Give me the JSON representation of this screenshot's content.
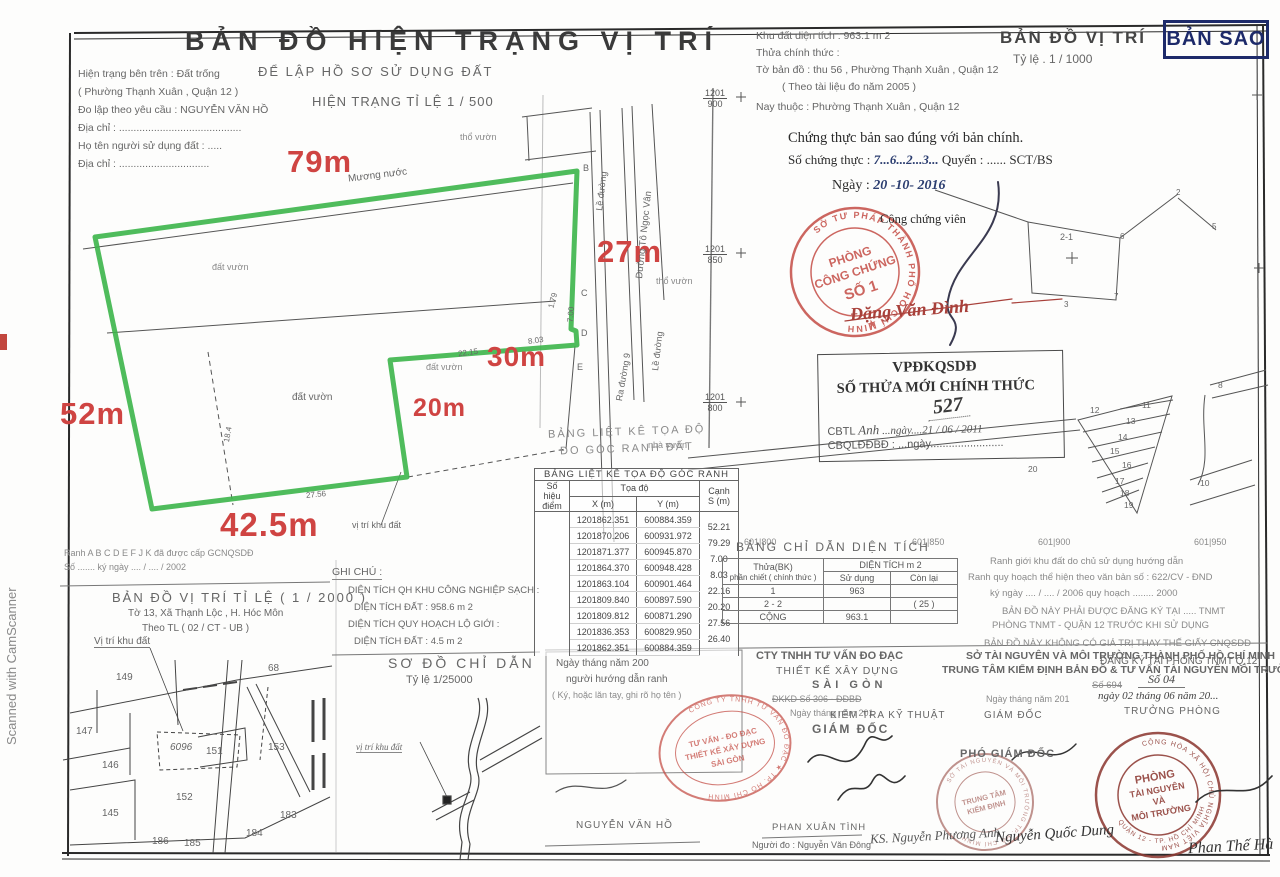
{
  "scan": {
    "watermark": "Scanned with CamScanner",
    "copy_label": "BẢN SAO"
  },
  "header_left": {
    "title": "BẢN ĐỒ HIỆN TRẠNG VỊ TRÍ",
    "subtitle": "ĐỂ LẬP HỒ SƠ SỬ DỤNG ĐẤT",
    "scale_line": "HIỆN TRẠNG TỈ LỆ 1 / 500",
    "lines": [
      "Hiện trạng bên trên : Đất trống",
      "( Phường Thạnh Xuân , Quận 12 )",
      "Đo lập theo yêu cầu : NGUYỄN VĂN HỒ",
      "Địa chỉ : ..........................................",
      "Họ tên người sử dụng đất : .....",
      "Địa chỉ : ..............................."
    ]
  },
  "header_right": {
    "lines": [
      "Khu đất diện tích :   963.1 m 2",
      "Thửa chính thức :",
      "Tờ bản đồ :   thu  56 , Phường Thạnh Xuân , Quận 12",
      "( Theo tài liệu đo năm 2005 )",
      "Nay thuộc :   Phường Thạnh Xuân , Quận 12"
    ],
    "map_title": "BẢN ĐỒ VỊ TRÍ",
    "map_scale": "Tỷ lệ  .  1 /  1000"
  },
  "certification": {
    "line1": "Chứng thực bản sao đúng với bản chính.",
    "line2_prefix": "Số chứng thực :",
    "line2_number": "7...6...2...3...",
    "line2_suffix": "Quyển : ......  SCT/BS",
    "date_label": "Ngày :",
    "date_value": "20 -10- 2016",
    "officer_label": "Công chứng viên",
    "officer_name": "Đặng Văn Đình"
  },
  "stamps": {
    "notary": {
      "ring": "SỞ TƯ PHÁP THÀNH PHỐ HỒ CHÍ MINH",
      "star": "★",
      "center": [
        "PHÒNG",
        "CÔNG CHỨNG",
        "SỐ 1"
      ]
    },
    "company": {
      "ring": "CÔNG TY TNHH TƯ VẤN ĐO ĐẠC ★ TP. HỒ CHÍ MINH",
      "center": [
        "TƯ VẤN - ĐO ĐẠC",
        "THIẾT KẾ XÂY DỰNG",
        "SÀI GÒN"
      ]
    },
    "tnmt": {
      "ring_top": "CỘNG HÒA XÃ HỘI CHỦ NGHĨA VIỆT NAM",
      "ring_bottom": "QUẬN 12 - TP. HỒ CHÍ MINH",
      "center": [
        "PHÒNG",
        "TÀI NGUYÊN",
        "VÀ",
        "MÔI TRƯỜNG"
      ]
    },
    "center_check": {
      "ring": "SỞ TÀI NGUYÊN VÀ MÔI TRƯỜNG TP. HỒ CHÍ MINH",
      "center": [
        "TRUNG TÂM",
        "KIỂM ĐỊNH"
      ]
    }
  },
  "vpdk": {
    "title": "VPĐKQSDĐ",
    "subtitle": "SỐ THỬA MỚI CHÍNH THỨC",
    "number": "527",
    "line1_label": "CBTL",
    "line1_hand": "Anh",
    "line1_date": "...ngày....21 / 06 / 2011",
    "line2_label": "CBQLĐĐBĐ :",
    "line2_date": "...ngày........................"
  },
  "survey": {
    "dims": {
      "top": "79m",
      "right": "27m",
      "mid": "30m",
      "inner": "20m",
      "left": "52m",
      "bottom": "42.5m"
    },
    "edge_numbers": [
      "1.79",
      "7.00",
      "8.03",
      "22.15",
      "27.56",
      "18.4"
    ],
    "points": [
      "B",
      "C",
      "D",
      "E"
    ],
    "labels": {
      "canal": "Mương nước",
      "garden1": "đất vườn",
      "garden2": "đất vườn",
      "garden3": "đất vườn",
      "tho1": "thổ vườn",
      "tho2": "thổ vườn",
      "nha": "nhà vườn",
      "road_side1": "Lề đường",
      "road_main": "Đường Tô Ngọc Vân",
      "road_side2": "Lề đường",
      "road_out": "Ra đường 9",
      "site": "vị trí khu đất"
    },
    "grid_fracs": [
      {
        "t": "1201",
        "b": "900"
      },
      {
        "t": "1201",
        "b": "850"
      },
      {
        "t": "1201",
        "b": "800"
      }
    ],
    "grid_labels": [
      "601|800",
      "601|850",
      "601|900",
      "601|950"
    ]
  },
  "coord_table": {
    "ghost1": "BẢNG LIỆT KÊ TỌA ĐỘ",
    "ghost2": "ĐO GÓC RANH ĐẤT",
    "title": "BẢNG LIỆT KÊ TỌA ĐỘ GÓC RANH",
    "col_point1": "Số hiệu",
    "col_point2": "điểm",
    "col_coord": "Tọa độ",
    "col_x": "X (m)",
    "col_y": "Y (m)",
    "col_edge1": "Cạnh",
    "col_edge2": "S (m)",
    "rows": [
      {
        "p": "",
        "x": "1201862.351",
        "y": "600884.359",
        "s": "52.21"
      },
      {
        "p": "",
        "x": "1201870.206",
        "y": "600931.972",
        "s": "79.29"
      },
      {
        "p": "",
        "x": "1201871.377",
        "y": "600945.870",
        "s": "7.00"
      },
      {
        "p": "",
        "x": "1201864.370",
        "y": "600948.428",
        "s": "8.03"
      },
      {
        "p": "",
        "x": "1201863.104",
        "y": "600901.464",
        "s": "22.16"
      },
      {
        "p": "",
        "x": "1201809.840",
        "y": "600897.590",
        "s": "20.20"
      },
      {
        "p": "",
        "x": "1201809.812",
        "y": "600871.290",
        "s": "27.56"
      },
      {
        "p": "",
        "x": "1201836.353",
        "y": "600829.950",
        "s": "26.40"
      },
      {
        "p": "",
        "x": "1201862.351",
        "y": "600884.359",
        "s": ""
      }
    ]
  },
  "area_table": {
    "title": "BẢNG CHỈ DẪN DIỆN TÍCH",
    "col1a": "Thửa(BK)",
    "col1b": "phần chiết ( chính thức )",
    "col2": "DIỆN TÍCH m 2",
    "col2a": "Sử dụng",
    "col2b": "Còn lại",
    "rows": [
      {
        "c1": "1",
        "c2": "963",
        "c3": ""
      },
      {
        "c1": "2 - 2",
        "c2": "",
        "c3": "( 25 )"
      },
      {
        "c1": "CỘNG",
        "c2": "963.1",
        "c3": ""
      }
    ]
  },
  "notes_right": {
    "lines": [
      "Ranh giới khu đất do chủ sử dụng hướng dẫn",
      "Ranh quy hoạch thể hiện theo văn bản số : 622/CV - ĐND",
      "ký ngày .... / .... / 2006   quy hoạch ........ 2000",
      "BẢN ĐỒ NÀY PHẢI ĐƯỢC ĐĂNG KÝ TẠI ..... TNMT",
      "PHÒNG TNMT - QUẬN 12 TRƯỚC KHI SỬ DỤNG",
      "BẢN ĐỒ NÀY KHÔNG CÓ GIÁ TRỊ THAY THẾ GIẤY CNQSDĐ"
    ]
  },
  "ghi_chu": {
    "title": "GHI CHÚ :",
    "lines": [
      "DIỆN TÍCH QH KHU CÔNG NGHIỆP SẠCH :",
      "DIỆN TÍCH ĐẤT :   958.6 m 2",
      "DIỆN TÍCH QUY HOẠCH LỘ GIỚI :",
      "DIỆN TÍCH ĐẤT :   4.5 m 2"
    ]
  },
  "map2000": {
    "pre1": "Ranh A B C D E F J K đã được cấp GCNQSDĐ",
    "pre2": "Số ....... ký ngày .... / .... / 2002",
    "title": "BẢN ĐỒ VỊ TRÍ TỈ LỆ ( 1 / 2000 )",
    "line2": "Tờ 13,  Xã Thạnh Lộc  ,  H. Hóc Môn",
    "line3": "Theo TL ( 02 / CT - UB )",
    "site_label": "Vị trí khu đất",
    "parcels": [
      "149",
      "68",
      "147",
      "146",
      "145",
      "6096",
      "151",
      "153",
      "152",
      "186",
      "185",
      "184",
      "183"
    ]
  },
  "map1000": {
    "plot": "2-1",
    "corners": [
      "2",
      "5",
      "6",
      "7",
      "3"
    ],
    "strips": [
      "11",
      "12",
      "13",
      "14",
      "15",
      "16",
      "17",
      "18",
      "19"
    ],
    "others": [
      "20",
      "8",
      "10"
    ]
  },
  "so_do": {
    "title": "SƠ ĐỒ CHỈ DẪN",
    "scale": "Tỷ lệ 1/25000",
    "site_label": "vị trí khu đất"
  },
  "sig": {
    "col1": {
      "date_line": "Ngày          tháng          năm 200",
      "role": "người hướng dẫn ranh",
      "note": "( Ký, hoặc lăn tay, ghi rõ họ tên )",
      "name": "NGUYỄN VĂN HỒ"
    },
    "col2": {
      "org1": "CTY TNHH TƯ VẤN ĐO ĐẠC",
      "org2": "THIẾT KẾ XÂY DỰNG",
      "org3": "SÀI GÒN",
      "reg": "ĐKKD  Số  306 - ĐĐBĐ",
      "date_line": "Ngày       tháng       năm 201",
      "role": "GIÁM ĐỐC",
      "name1": "PHAN XUÂN TÌNH",
      "name2": "Người đo :  Nguyễn Văn Đông",
      "name3": "KS. Nguyễn Phương Anh"
    },
    "col3": {
      "org1": "SỞ TÀI NGUYÊN  VÀ  MÔI TRƯỜNG THÀNH PHỐ HỒ CHÍ MINH",
      "org2": "TRUNG TÂM KIỂM ĐỊNH BẢN ĐỒ & TƯ VẤN TÀI NGUYÊN MÔI TRƯỜNG",
      "reg": "Số  694",
      "date_line": "Ngày       tháng       năm 201",
      "role1": "KIỂM TRA KỸ THUẬT",
      "role2": "GIÁM ĐỐC",
      "role3": "PHÓ GIÁM ĐỐC",
      "name": "Nguyễn Quốc Dung"
    },
    "col4": {
      "title": "ĐĂNG KÝ TẠI PHÒNG TNMT Q.12",
      "reg": "Số  04",
      "date_line": "ngày 02 tháng 06 năm 20...",
      "role": "TRƯỞNG PHÒNG",
      "name": "Phan Thế Hà"
    }
  },
  "colors": {
    "plot_outline": "#3cb54a",
    "dimension_red": "#cf4442",
    "stamp_red": "#c2463e",
    "copy_navy": "#1d2a6a"
  }
}
